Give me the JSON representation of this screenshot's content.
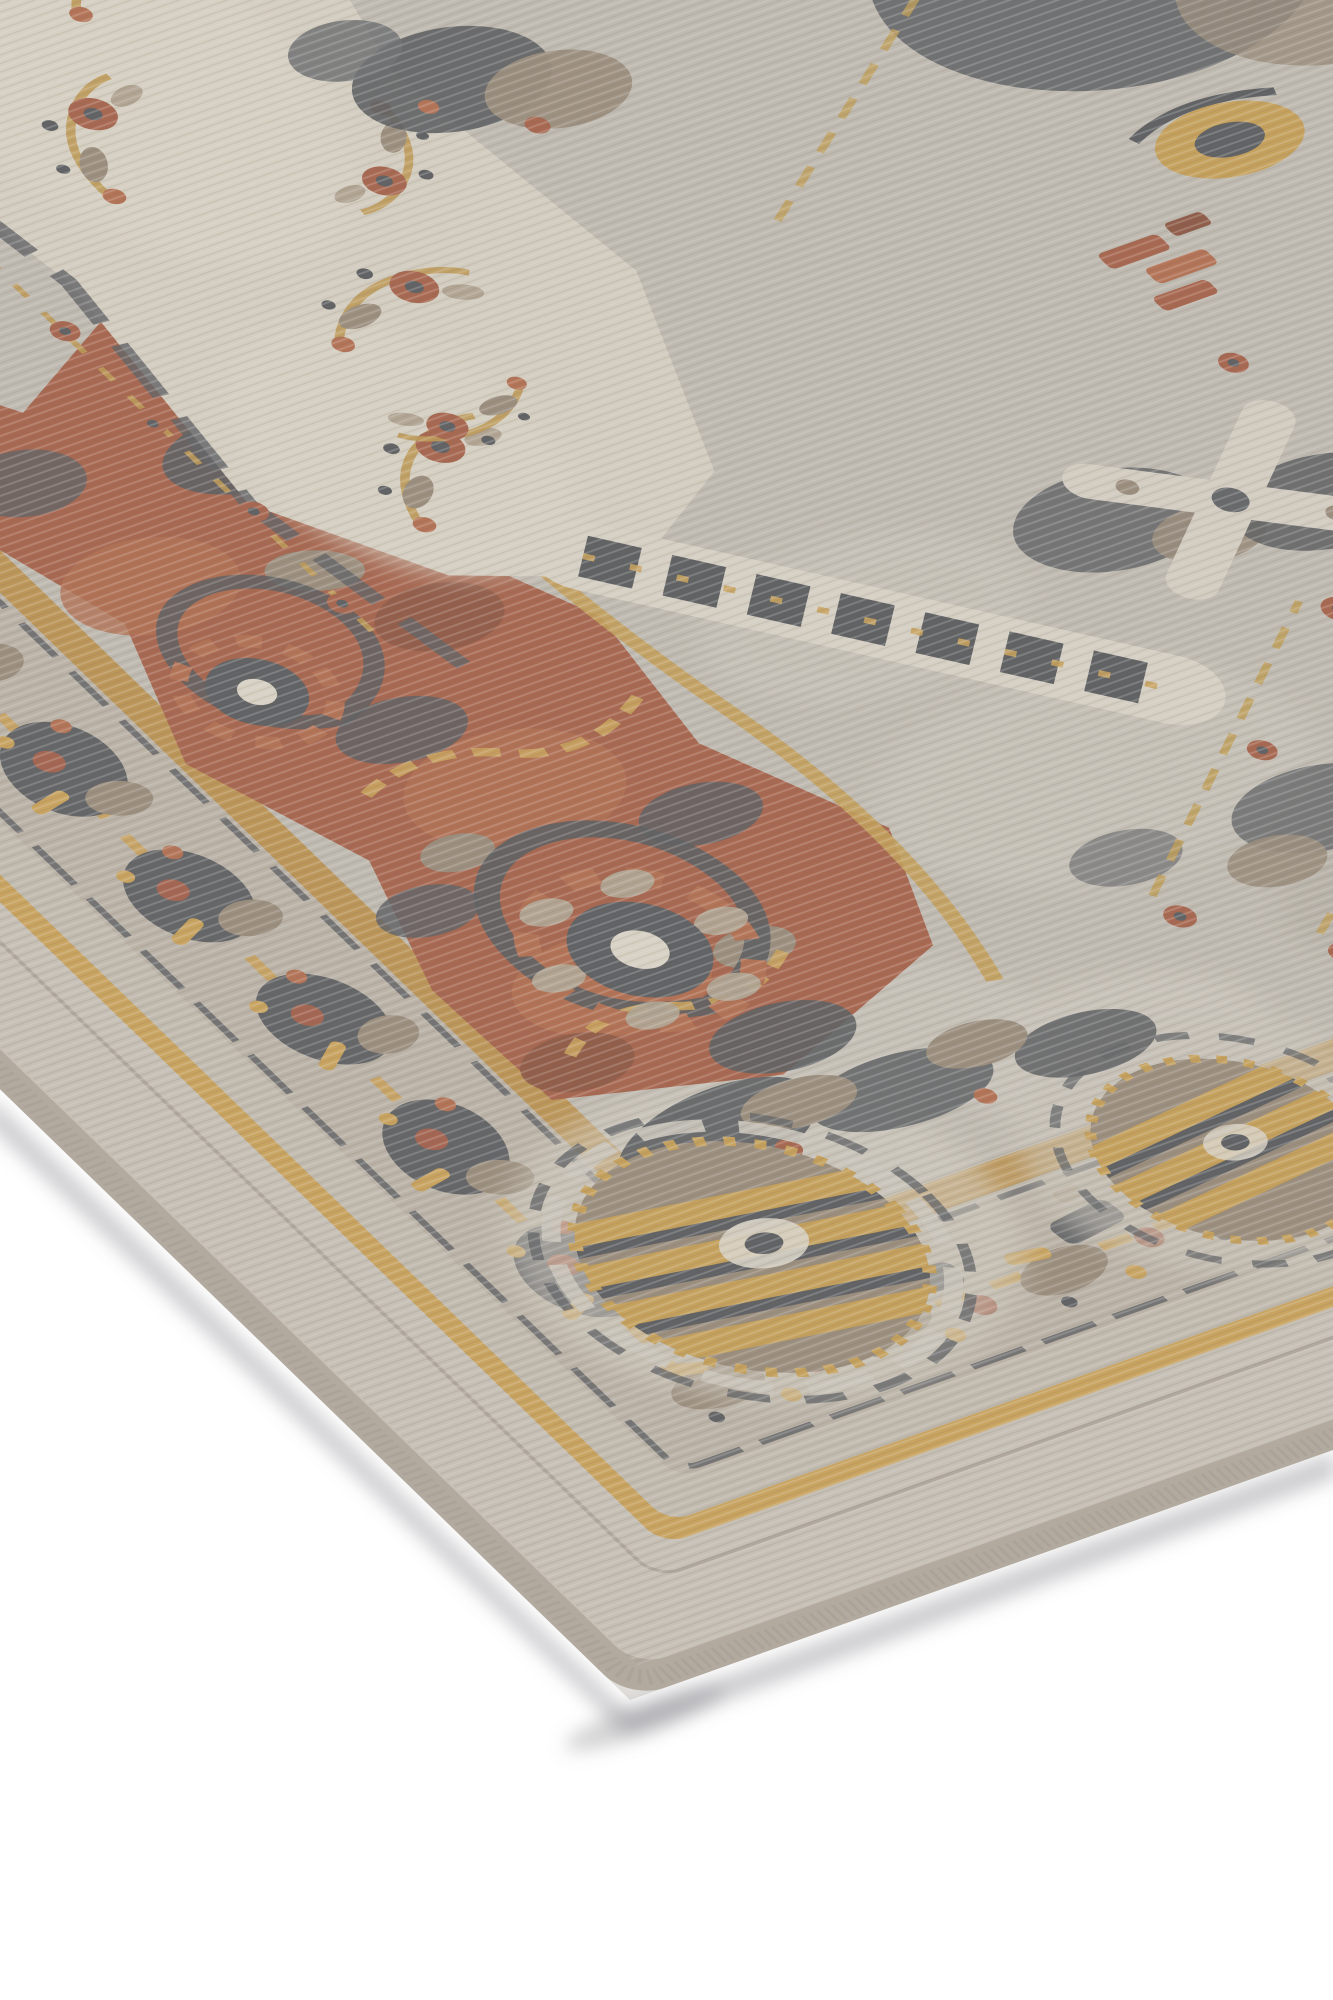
{
  "scene": {
    "type": "product-photograph",
    "subject": "area-rug-corner",
    "description": "Angled close-up of the corner of a distressed vintage-style area rug on a white studio floor. The rug has a grey serged edge binding, a plain grey outer border framed by gold pinstripes, an ornamental border band with taupe, charcoal, gold and rust motifs, and a distressed field mixing cream, silver-grey and rust-red zones with floral sprays, charcoal medallion outlines, a dark Greek-key band and large gold-striped rosettes."
  },
  "colors": {
    "floor": "#ffffff",
    "shadow": "#8c8c92",
    "binding": "#b2a99c",
    "binding_rope": "#9b9385",
    "band_plain": "#d3ccc0",
    "band_plain2": "#cbc4b6",
    "groove": "#a89f92",
    "gold": "#d89f35",
    "gold_deep": "#c3892a",
    "border_base": "#c0b7a8",
    "border_dark": "#3a4048",
    "field_silver": "#c8c3b8",
    "silver_light": "#d9d5ca",
    "silver_dark": "#b3aea2",
    "cream": "#e8e1d1",
    "ivory": "#f0ead9",
    "red": "#a23e1d",
    "red_dark": "#7b2c12",
    "red_bright": "#b55127",
    "charcoal": "#2f353d",
    "slate": "#4a5058",
    "taupe": "#8e7d67",
    "taupe_light": "#b3a28a"
  },
  "regions": {
    "floor": "white floor",
    "binding": "edge binding",
    "outer_band": "plain outer border",
    "pinstripe": "gold pinstripe frame",
    "ornament_border": "ornamental border band",
    "field": "distressed field",
    "cream_zone": "cream floral zone",
    "red_zone": "rust medallion zone",
    "rosettes": "gold rosettes"
  }
}
